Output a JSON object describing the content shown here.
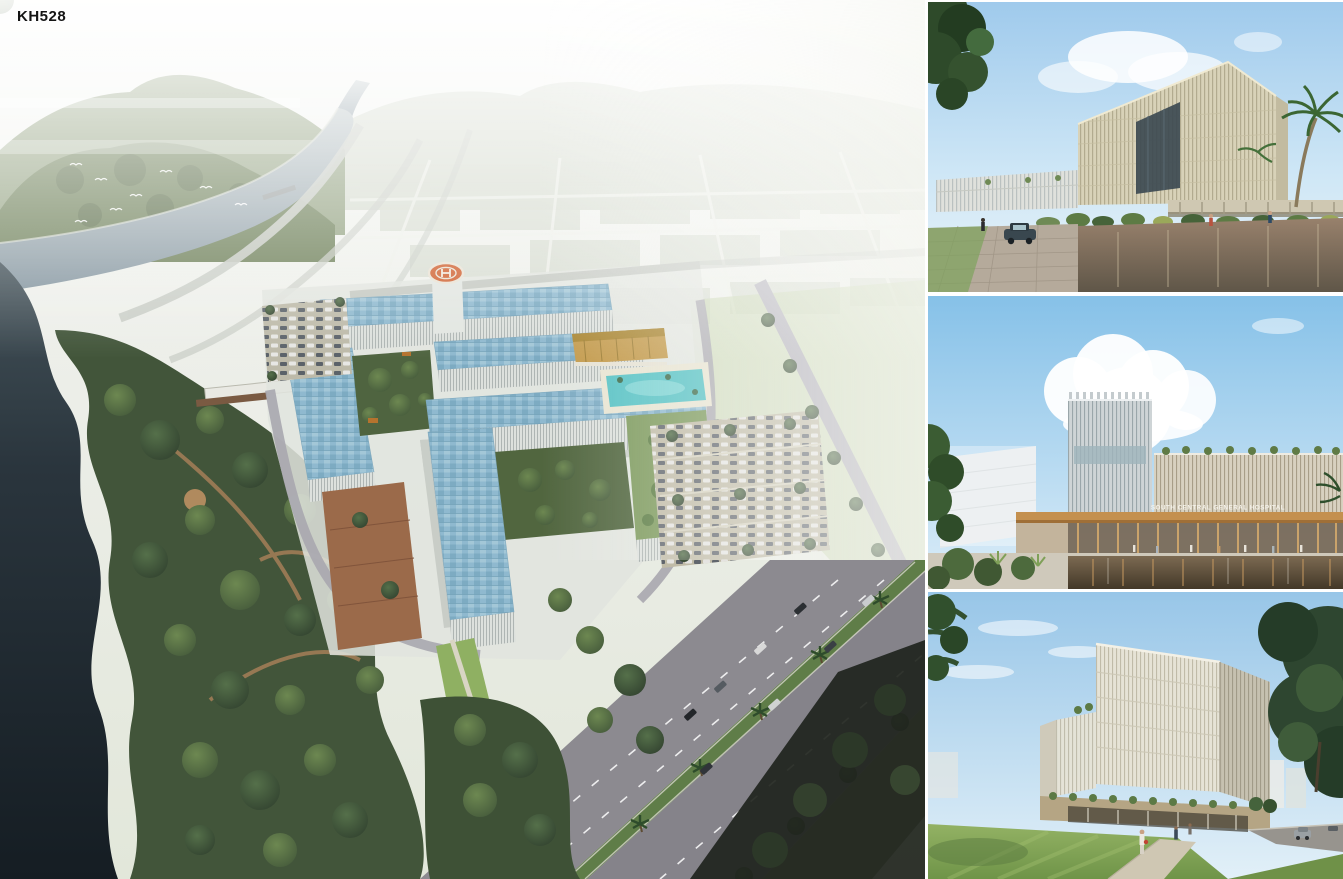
{
  "board": {
    "code_label": "KH528"
  },
  "hero": {
    "name": "aerial-masterplan-render",
    "subject": "Aerial view of riverside hospital campus with blue glass roofs, helipad, parking and tree park"
  },
  "side_panels": [
    {
      "name": "entry-drive-render",
      "subject": "Eye-level view of hospital entry drive with angled fin facade and palm"
    },
    {
      "name": "main-entrance-render",
      "subject": "Main entrance with timber canopy and reflecting pool",
      "signage": "SOUTH CENTRAL GENERAL HOSPITAL"
    },
    {
      "name": "street-corner-render",
      "subject": "Street corner view of ward block above landscaped podium and lawn"
    }
  ],
  "palette": {
    "sky_blue": "#9fcaec",
    "haze_white": "#f2f4f0",
    "mountain_green": "#72835f",
    "river_gray": "#9aa9af",
    "lake_dark": "#1e2930",
    "tree_green": "#4a5f3d",
    "lawn_green": "#8fae5e",
    "roof_glass_blue": "#8fb9cf",
    "facade_white": "#dde1dd",
    "facade_cream": "#d9d3b9",
    "timber_canopy": "#c08a50",
    "gold_facade": "#c39a4b",
    "pool_turquoise": "#57c2c4",
    "helipad_orange": "#cf5f2e",
    "asphalt": "#a7a5ad"
  }
}
